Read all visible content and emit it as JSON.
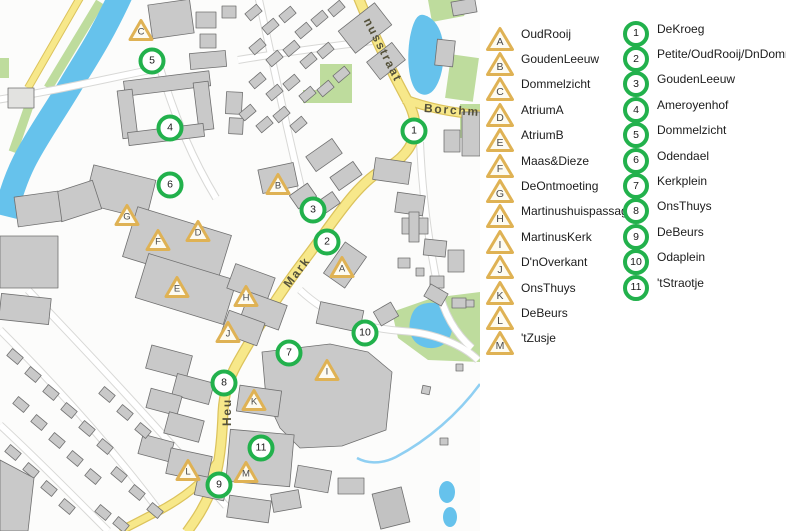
{
  "legend": {
    "triangle_items": [
      {
        "label": "A",
        "name": "OudRooij"
      },
      {
        "label": "B",
        "name": "GoudenLeeuw"
      },
      {
        "label": "C",
        "name": "Dommelzicht"
      },
      {
        "label": "D",
        "name": "AtriumA"
      },
      {
        "label": "E",
        "name": "AtriumB"
      },
      {
        "label": "F",
        "name": "Maas&Dieze"
      },
      {
        "label": "G",
        "name": "DeOntmoeting"
      },
      {
        "label": "H",
        "name": "Martinushuispassage"
      },
      {
        "label": "I",
        "name": "MartinusKerk"
      },
      {
        "label": "J",
        "name": "D'nOverkant"
      },
      {
        "label": "K",
        "name": "OnsThuys"
      },
      {
        "label": "L",
        "name": "DeBeurs"
      },
      {
        "label": "M",
        "name": "'tZusje"
      }
    ],
    "circle_items": [
      {
        "label": "1",
        "name": "DeKroeg"
      },
      {
        "label": "2",
        "name": "Petite/OudRooij/DnDommel"
      },
      {
        "label": "3",
        "name": "GoudenLeeuw"
      },
      {
        "label": "4",
        "name": "Ameroyenhof"
      },
      {
        "label": "5",
        "name": "Dommelzicht"
      },
      {
        "label": "6",
        "name": "Odendael"
      },
      {
        "label": "7",
        "name": "Kerkplein"
      },
      {
        "label": "8",
        "name": "OnsThuys"
      },
      {
        "label": "9",
        "name": "DeBeurs"
      },
      {
        "label": "10",
        "name": "Odaplein"
      },
      {
        "label": "11",
        "name": "'tStraotje"
      }
    ]
  },
  "map": {
    "markers": [
      {
        "type": "triangle",
        "label": "C",
        "x": 141,
        "y": 30
      },
      {
        "type": "circle",
        "label": "5",
        "x": 152,
        "y": 61
      },
      {
        "type": "circle",
        "label": "1",
        "x": 414,
        "y": 131
      },
      {
        "type": "circle",
        "label": "4",
        "x": 170,
        "y": 128
      },
      {
        "type": "circle",
        "label": "6",
        "x": 170,
        "y": 185
      },
      {
        "type": "triangle",
        "label": "B",
        "x": 278,
        "y": 184
      },
      {
        "type": "circle",
        "label": "3",
        "x": 313,
        "y": 210
      },
      {
        "type": "triangle",
        "label": "G",
        "x": 127,
        "y": 215
      },
      {
        "type": "triangle",
        "label": "D",
        "x": 198,
        "y": 231
      },
      {
        "type": "triangle",
        "label": "F",
        "x": 158,
        "y": 240
      },
      {
        "type": "circle",
        "label": "2",
        "x": 327,
        "y": 242
      },
      {
        "type": "triangle",
        "label": "A",
        "x": 342,
        "y": 267
      },
      {
        "type": "triangle",
        "label": "E",
        "x": 177,
        "y": 287
      },
      {
        "type": "triangle",
        "label": "H",
        "x": 246,
        "y": 296
      },
      {
        "type": "triangle",
        "label": "J",
        "x": 228,
        "y": 332
      },
      {
        "type": "circle",
        "label": "10",
        "x": 365,
        "y": 333
      },
      {
        "type": "circle",
        "label": "7",
        "x": 289,
        "y": 353
      },
      {
        "type": "triangle",
        "label": "I",
        "x": 327,
        "y": 370
      },
      {
        "type": "circle",
        "label": "8",
        "x": 224,
        "y": 383
      },
      {
        "type": "triangle",
        "label": "K",
        "x": 254,
        "y": 400
      },
      {
        "type": "circle",
        "label": "11",
        "x": 261,
        "y": 448
      },
      {
        "type": "triangle",
        "label": "L",
        "x": 188,
        "y": 470
      },
      {
        "type": "triangle",
        "label": "M",
        "x": 246,
        "y": 472
      },
      {
        "type": "circle",
        "label": "9",
        "x": 219,
        "y": 485
      }
    ],
    "street_labels": [
      {
        "text": "nusstraat",
        "x": 383,
        "y": 50,
        "rotate": 63
      },
      {
        "text": "Borchm",
        "x": 452,
        "y": 110,
        "rotate": 4
      },
      {
        "text": "Mark",
        "x": 297,
        "y": 272,
        "rotate": -52
      },
      {
        "text": "Heu",
        "x": 227,
        "y": 412,
        "rotate": -90
      }
    ]
  },
  "colors": {
    "marker_circle_ring": "#22B14C",
    "marker_triangle_border": "#DFB254",
    "road_yellow": "#F7E88A",
    "water_blue": "#66C2EC",
    "green_area": "#BEDC9D",
    "building_gray": "#C9C9C9"
  }
}
